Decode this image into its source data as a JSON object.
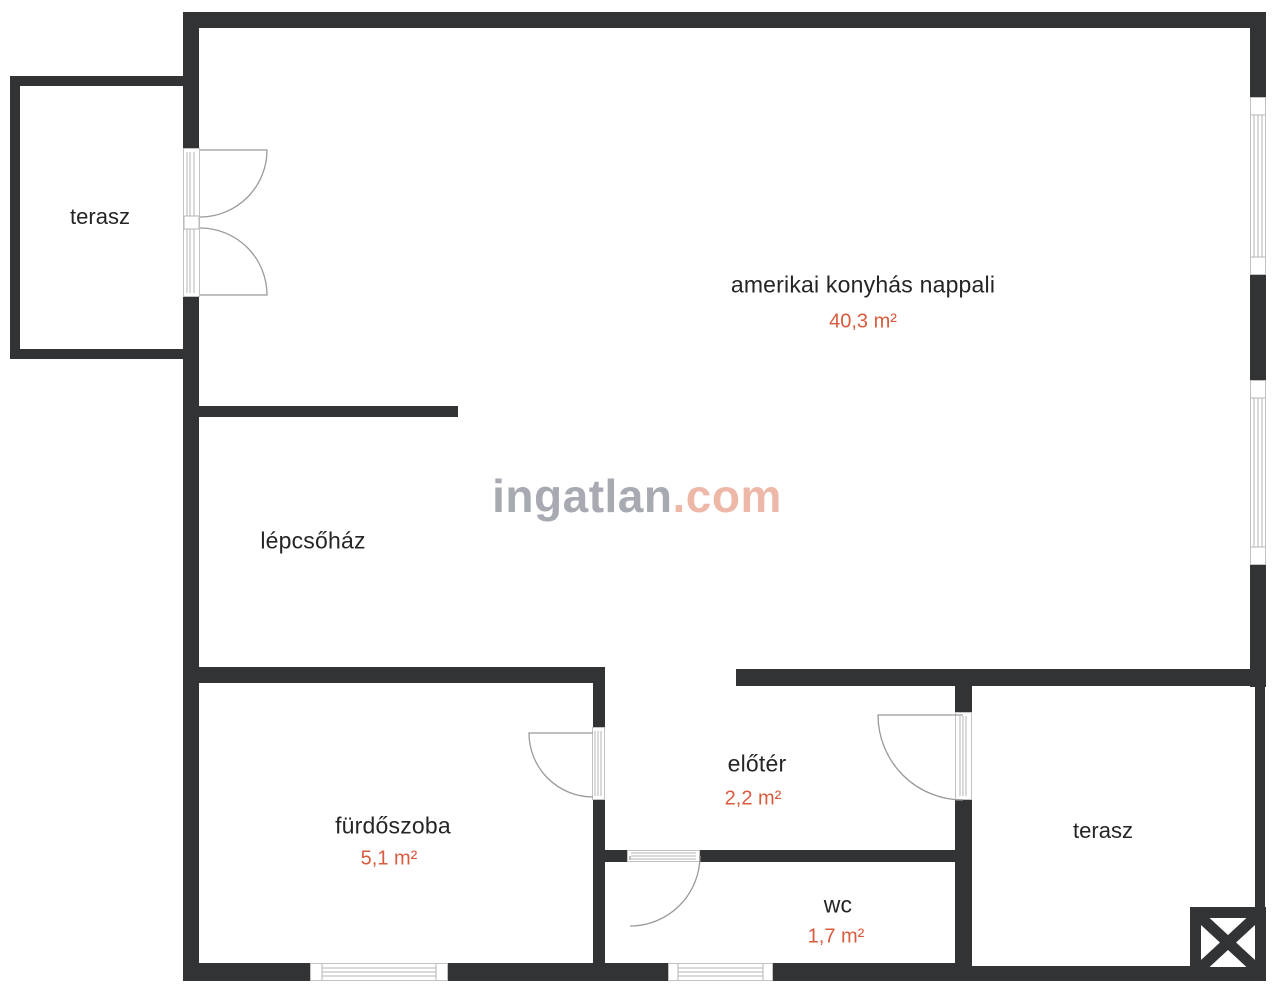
{
  "title": "floor-plan",
  "rooms": [
    {
      "name": "terasz",
      "area": ""
    },
    {
      "name": "amerikai konyhás nappali",
      "area": "40,3 m²"
    },
    {
      "name": "lépcsőház",
      "area": ""
    },
    {
      "name": "fürdőszoba",
      "area": "5,1 m²"
    },
    {
      "name": "előtér",
      "area": "2,2 m²"
    },
    {
      "name": "wc",
      "area": "1,7 m²"
    },
    {
      "name": "terasz",
      "area": ""
    }
  ],
  "watermark": {
    "brand": "ingatlan",
    "suffix": ".com"
  },
  "colors": {
    "wall": "#323335",
    "room_text": "#252525",
    "area_text": "#d95b3e",
    "watermark_gray": "#a7aab1",
    "watermark_accent": "#eeb8a8",
    "thin_line": "#9a9a9a",
    "window_frame": "#c2c2c2"
  }
}
